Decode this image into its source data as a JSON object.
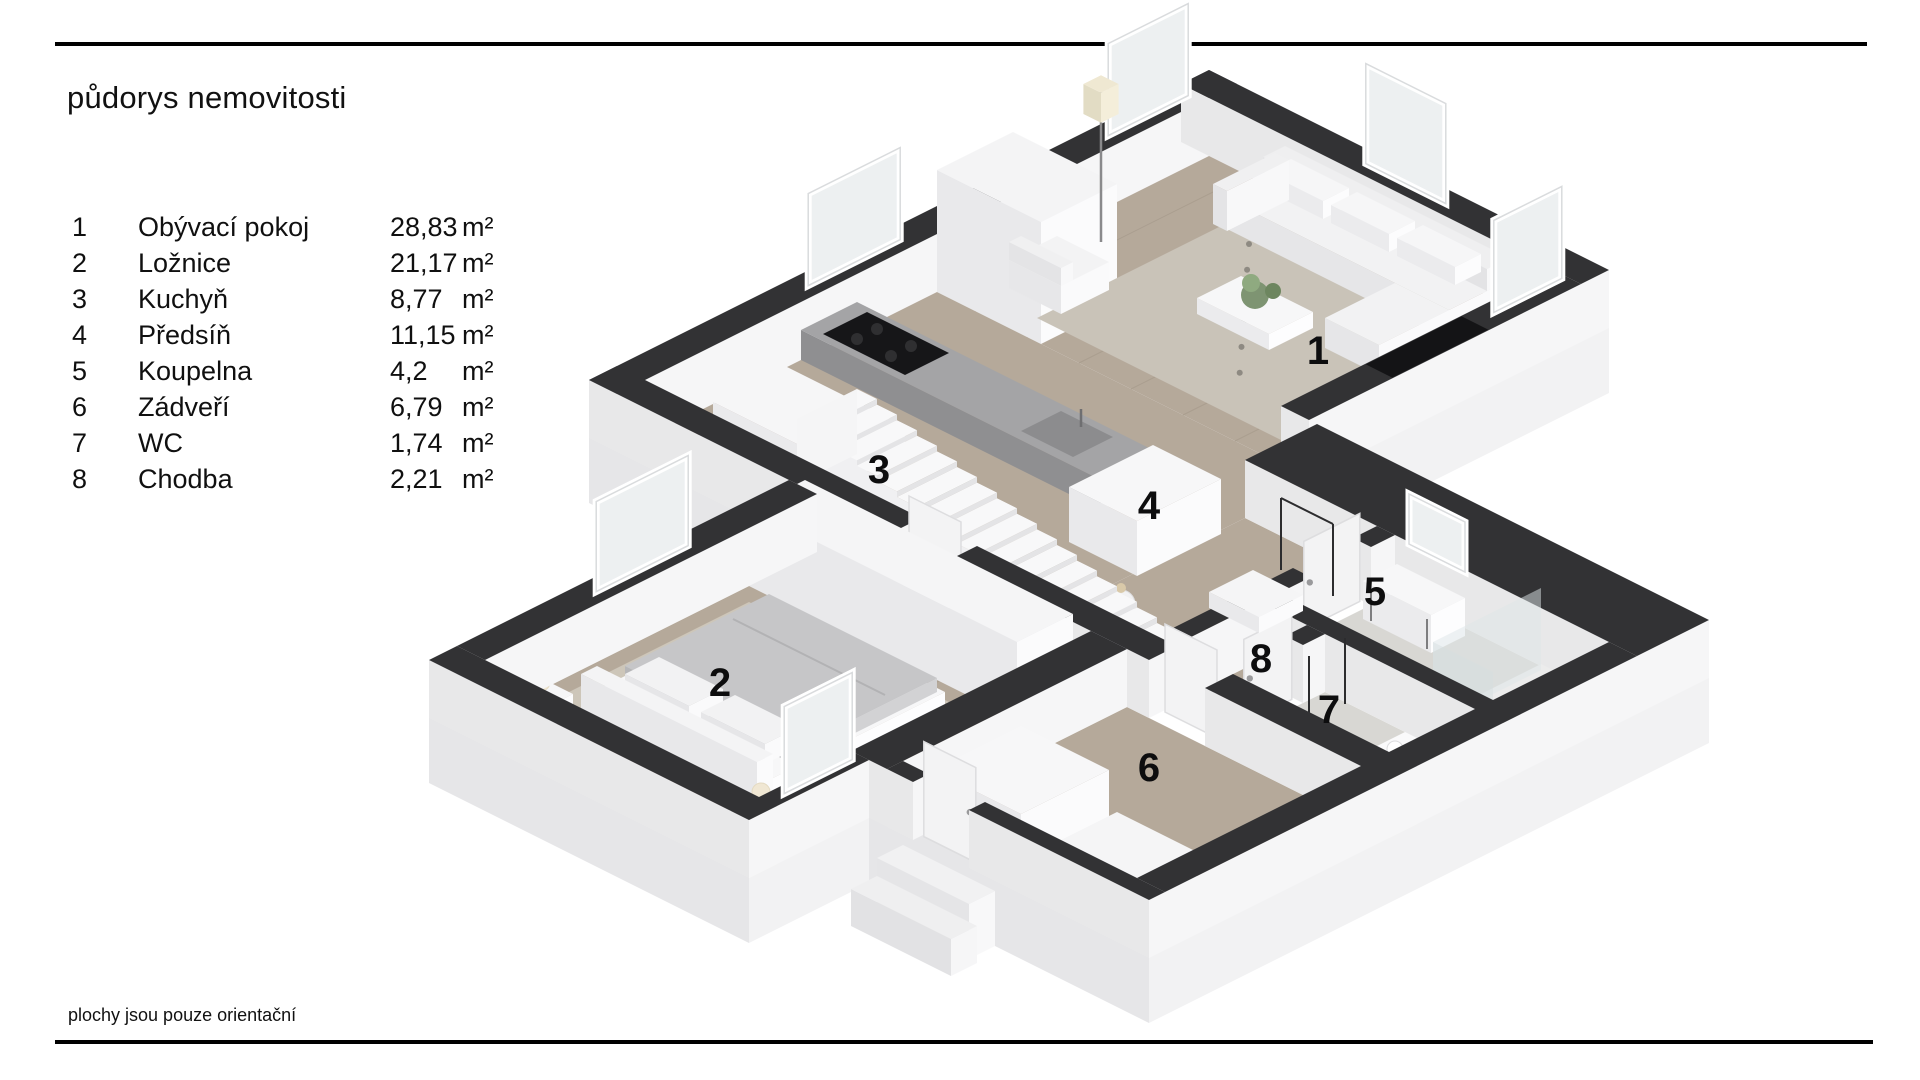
{
  "header": {
    "title": "půdorys nemovitosti"
  },
  "legend": {
    "rooms": [
      {
        "number": "1",
        "name": "Obývací pokoj",
        "area": "28,83",
        "unit": "m²"
      },
      {
        "number": "2",
        "name": "Ložnice",
        "area": "21,17",
        "unit": "m²"
      },
      {
        "number": "3",
        "name": "Kuchyň",
        "area": "8,77",
        "unit": "m²"
      },
      {
        "number": "4",
        "name": "Předsíň",
        "area": "11,15",
        "unit": "m²"
      },
      {
        "number": "5",
        "name": "Koupelna",
        "area": "4,2",
        "unit": "m²"
      },
      {
        "number": "6",
        "name": "Zádveří",
        "area": "6,79",
        "unit": "m²"
      },
      {
        "number": "7",
        "name": "WC",
        "area": "1,74",
        "unit": "m²"
      },
      {
        "number": "8",
        "name": "Chodba",
        "area": "2,21",
        "unit": "m²"
      }
    ]
  },
  "footer": {
    "note": "plochy jsou pouze orientační"
  },
  "plan": {
    "type": "isometric-3d-floorplan",
    "colors": {
      "wall_top": "#323234",
      "wall_side": "#f6f6f7",
      "floor_wood": "#b5a99a",
      "floor_tile": "#d8d7d3",
      "rug": "#c9c3b8",
      "background": "#ffffff"
    }
  }
}
